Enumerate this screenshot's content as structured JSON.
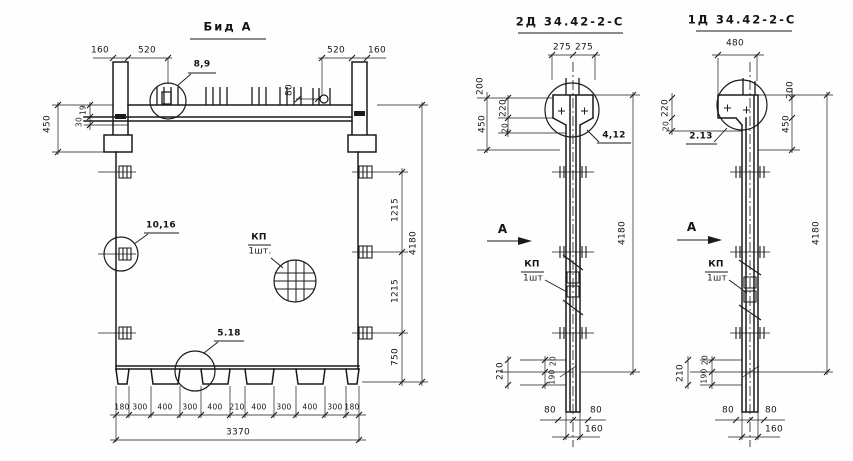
{
  "drawing": {
    "view_a": {
      "title": "Бид А",
      "top_dims": [
        "160",
        "520",
        "520",
        "160"
      ],
      "dowel_spacing": "80",
      "detail_top": "8,9",
      "detail_left": "10,16",
      "detail_bottom": "5.18",
      "kp_label": "КП",
      "kp_qty": "1шт.",
      "left_dims": {
        "overall": "450",
        "upper": "19",
        "lower": "30"
      },
      "right_dims": {
        "seg1": "1215",
        "seg2": "1215",
        "seg3": "750",
        "overall": "4180"
      },
      "bottom_dims": [
        "180",
        "300",
        "400",
        "300",
        "400",
        "210",
        "400",
        "300",
        "400",
        "300",
        "180"
      ],
      "bottom_overall": "3370"
    },
    "view_2d": {
      "title": "2Д 34.42-2-С",
      "top_dims": [
        "275",
        "275"
      ],
      "left_dims": {
        "d200": "200",
        "d450": "450",
        "d220": "220",
        "d20": "20"
      },
      "detail_label": "4,12",
      "section_letter": "А",
      "kp_label": "КП",
      "kp_qty": "1шт",
      "overall": "4180",
      "foot_dims": {
        "d210": "210",
        "d190": "190",
        "d20": "20"
      },
      "bottom_dims": {
        "left": "80",
        "right": "80",
        "overall": "160"
      }
    },
    "view_1d": {
      "title": "1Д 34.42-2-С",
      "top_dim": "480",
      "left_dims": {
        "d220": "220",
        "d20": "20"
      },
      "right_dims": {
        "d200": "200",
        "d450": "450"
      },
      "detail_label": "2.13",
      "section_letter": "А",
      "kp_label": "КП",
      "kp_qty": "1шт",
      "overall": "4180",
      "foot_dims": {
        "d210": "210",
        "d190": "190",
        "d20": "20"
      },
      "bottom_dims": {
        "left": "80",
        "right": "80",
        "overall": "160"
      }
    }
  }
}
